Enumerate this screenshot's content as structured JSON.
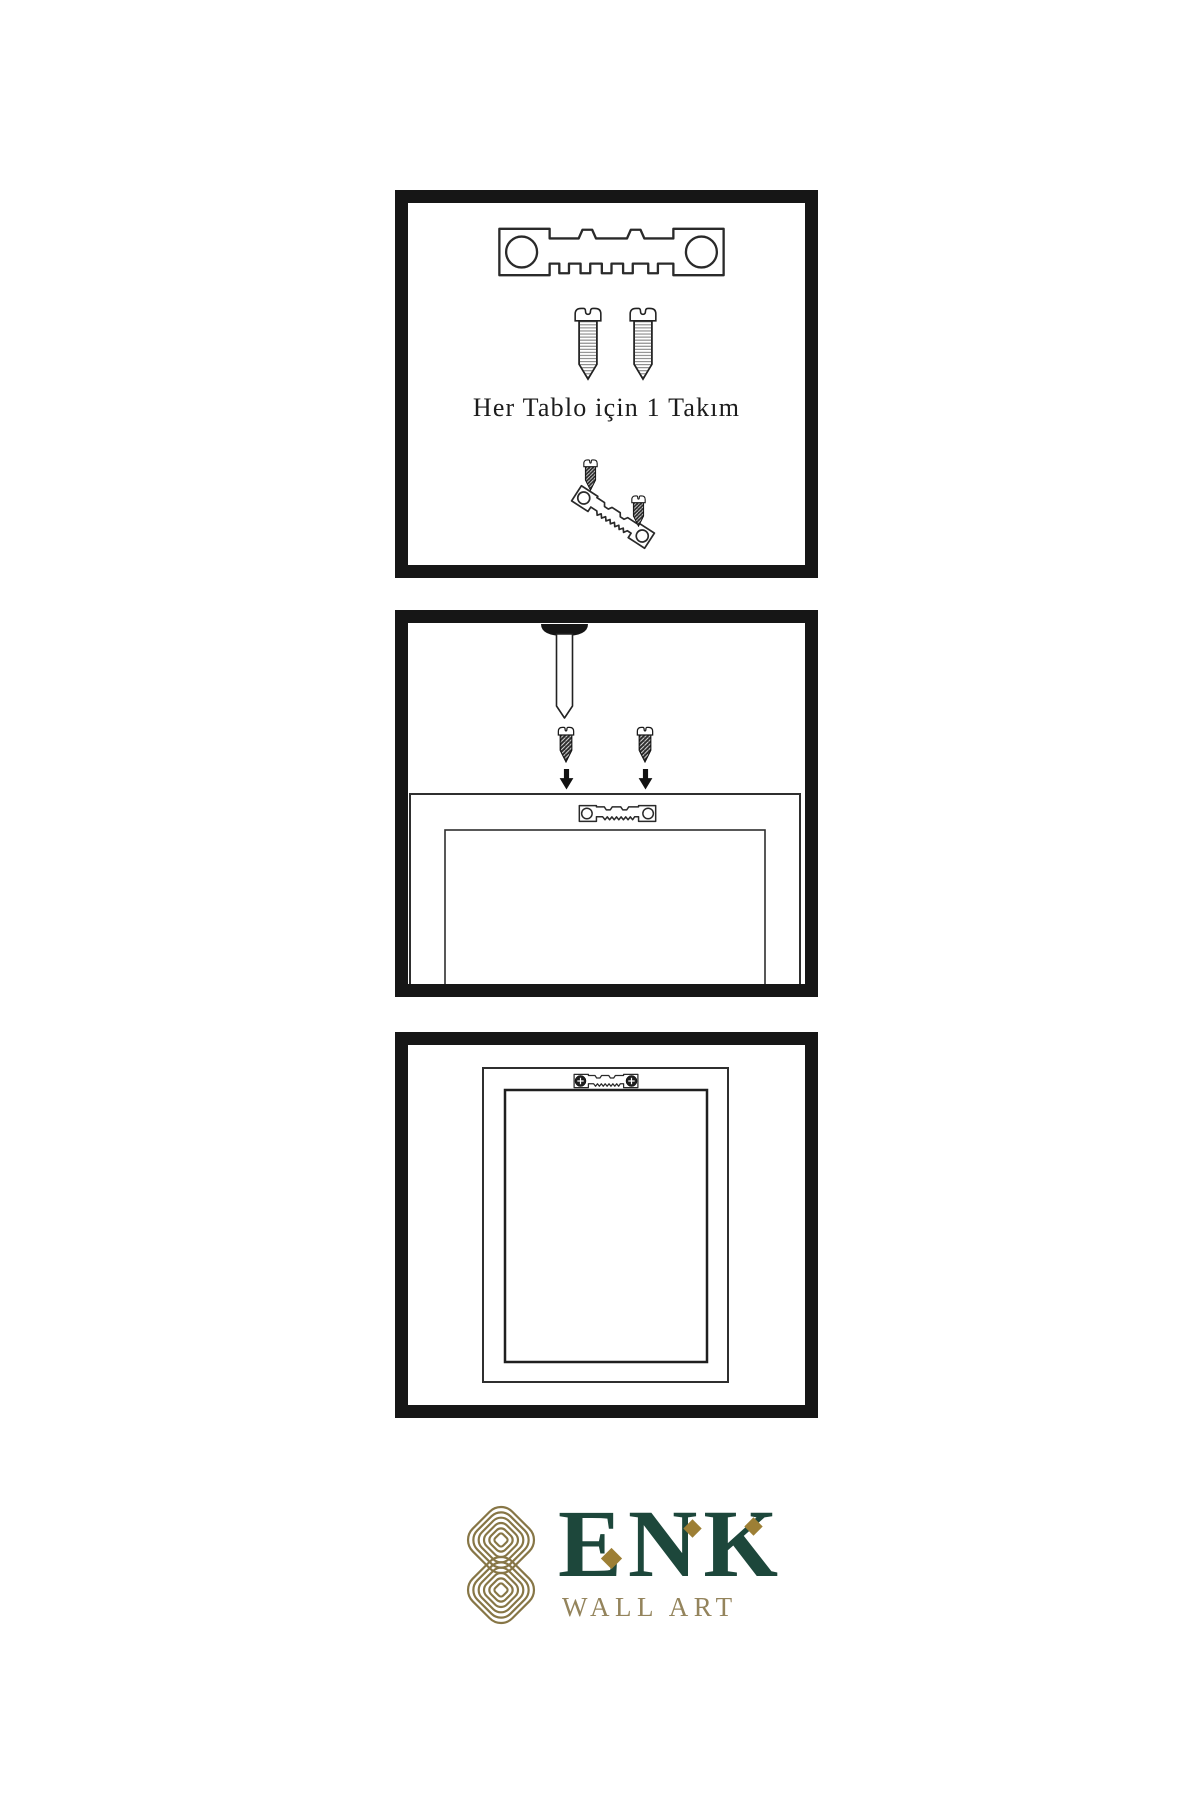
{
  "colors": {
    "ink": "#161616",
    "line": "#2a2a2a",
    "green": "#1d473b",
    "gold": "#877646",
    "gold_text": "#94845c",
    "gold_diamond": "#9d7f35"
  },
  "panel_hardware": {
    "label": "Her Tablo için 1 Takım"
  },
  "logo": {
    "brand": "ENK",
    "subtitle": "WALL ART"
  },
  "icons": {
    "hanger": "sawtooth-hanger-icon",
    "screw": "screw-icon",
    "dark_screw": "dark-screw-icon",
    "nail": "nail-icon",
    "arrow": "arrow-down-icon",
    "frame": "frame-outline",
    "knot": "knot-icon"
  }
}
